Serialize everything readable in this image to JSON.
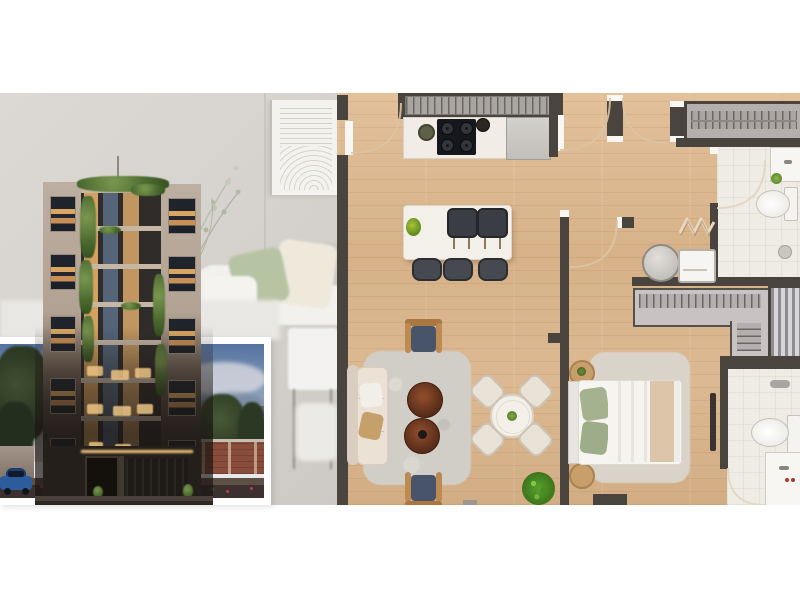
{
  "image_type": "real-estate marketing composite; photographic renders, no visible text",
  "palette": {
    "page_bg": "#ffffff",
    "backdrop_wall": "#d7d3ce",
    "plan_wall": "#4a443f",
    "plan_floor_wood": "#d9b58c",
    "bathroom_floor": "#efece5",
    "window_glow": "#d9a763",
    "greenery": "#5a7a3f",
    "dusk_sky_top": "#5a7cab",
    "dusk_sky_bottom": "#c6cfd6",
    "inset_frame": "#ffffff",
    "navy_cushion": "#475469",
    "walnut_table": "#5f301c"
  },
  "backdrop_interior": {
    "label": "blurred living room backdrop",
    "art_panel": "white panel with engraved line arcs",
    "sofa_cushion_colors": [
      "#b7c4a4",
      "#efe9dc",
      "#c9c9c4"
    ],
    "plant": "thin branch wisps"
  },
  "building_render": {
    "label": "mid-rise residential building with vertical gardens",
    "towers": 2,
    "tower_color": "#b2a294",
    "balcony_floors_visible": 8,
    "tower_windows_per_side": 5,
    "window_glow": "#d9a763",
    "rooftop": "green planting and thin antenna",
    "ground_floor": "dark lobby and garage with warm LED strip"
  },
  "inset_photo": {
    "label": "dusk street view in white frame",
    "frame_color": "#ffffff",
    "sky": [
      "#5a7cab",
      "#93abc7",
      "#c6cfd6"
    ],
    "elements": [
      "clouds",
      "trees left",
      "trees right",
      "neighbor house with dark windows",
      "brick wall with pillars",
      "light boundary wall",
      "blue car",
      "dark street",
      "red flower border"
    ]
  },
  "floor_plan": {
    "label": "top-down 3D apartment floor plan on light oak planks",
    "door_arcs": 6,
    "rooms": {
      "kitchen": {
        "label": "kitchen",
        "items": [
          "wall counter with ribbed rack",
          "4-burner cooktop",
          "round sink",
          "kettle",
          "refrigerator",
          "white island",
          "2 dark bar trays",
          "3 bar stools",
          "small plant"
        ]
      },
      "living_dining": {
        "label": "living-dining room",
        "items": [
          "beige sofa with tan pillow",
          "2 wood armchairs with navy cushions",
          "2 round walnut coffee tables",
          "shaggy gray rug",
          "round dining table",
          "4 cream dining chairs",
          "potted plant"
        ]
      },
      "hallway": {
        "label": "hallway",
        "items": [
          "entry door arc",
          "two double-door arcs"
        ]
      },
      "bathroom_top": {
        "label": "bathroom 1",
        "items": [
          "vanity with plant",
          "toilet",
          "shower drain",
          "zigzag towel radiator"
        ]
      },
      "laundry_nook": {
        "label": "laundry nook",
        "items": [
          "round laundry basket",
          "small white cabinet"
        ]
      },
      "closet": {
        "label": "walk-in closet",
        "items": [
          "L-shaped wardrobe with hanger ticks",
          "striped sliding wardrobe"
        ]
      },
      "bedroom": {
        "label": "bedroom",
        "items": [
          "double bed",
          "2 sage pillows",
          "beige blanket band",
          "2 round nightstands",
          "shaggy rug",
          "open door leaf"
        ]
      },
      "bathroom_bottom": {
        "label": "bathroom 2",
        "items": [
          "toilet",
          "vanity with red taps",
          "towel bar"
        ]
      }
    },
    "counts": {
      "bar_stools": 3,
      "dining_chairs": 4,
      "cooktop_burners": 4,
      "coffee_tables": 2,
      "nightstands": 2,
      "toilets": 2
    }
  }
}
